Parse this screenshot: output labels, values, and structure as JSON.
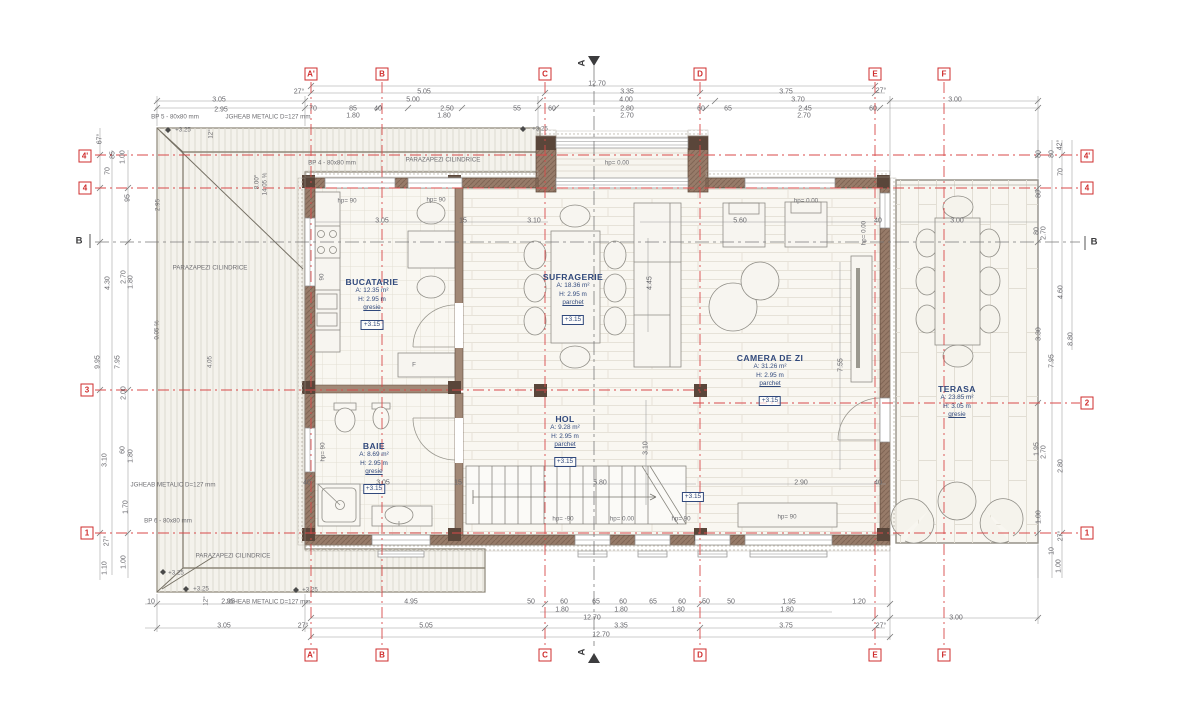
{
  "drawing_title": "Floor plan - parter/etaj",
  "colors": {
    "grid_red": "#d84a4a",
    "wall_brown": "#977b69",
    "wall_dark": "#5d4939",
    "room_label_blue": "#31497c",
    "dim_gray": "#67676c",
    "roof_fill": "#f4f2ec",
    "floor_cream": "#f9f7f1"
  },
  "grid": {
    "markers": [
      {
        "t": "A'",
        "x": 311,
        "y": 74
      },
      {
        "t": "B",
        "x": 382,
        "y": 74
      },
      {
        "t": "C",
        "x": 545,
        "y": 74
      },
      {
        "t": "D",
        "x": 700,
        "y": 74
      },
      {
        "t": "E",
        "x": 875,
        "y": 74
      },
      {
        "t": "F",
        "x": 944,
        "y": 74
      },
      {
        "t": "A'",
        "x": 311,
        "y": 655
      },
      {
        "t": "B",
        "x": 382,
        "y": 655
      },
      {
        "t": "C",
        "x": 545,
        "y": 655
      },
      {
        "t": "D",
        "x": 700,
        "y": 655
      },
      {
        "t": "E",
        "x": 875,
        "y": 655
      },
      {
        "t": "F",
        "x": 944,
        "y": 655
      },
      {
        "t": "4'",
        "x": 85,
        "y": 156
      },
      {
        "t": "4",
        "x": 85,
        "y": 188
      },
      {
        "t": "3",
        "x": 87,
        "y": 390
      },
      {
        "t": "1",
        "x": 87,
        "y": 533
      },
      {
        "t": "4'",
        "x": 1087,
        "y": 156
      },
      {
        "t": "4",
        "x": 1087,
        "y": 188
      },
      {
        "t": "2",
        "x": 1087,
        "y": 403
      },
      {
        "t": "1",
        "x": 1087,
        "y": 533
      }
    ]
  },
  "rooms": [
    {
      "id": "bucatarie",
      "name": "BUCATARIE",
      "area": "A: 12.35 m²",
      "height": "H: 2.95 m",
      "floor": "gresie",
      "level": "+3.15",
      "x": 372,
      "y": 277
    },
    {
      "id": "sufragerie",
      "name": "SUFRAGERIE",
      "area": "A: 18.36 m²",
      "height": "H: 2.95 m",
      "floor": "parchet",
      "level": "+3.15",
      "x": 573,
      "y": 272
    },
    {
      "id": "camera-de-zi",
      "name": "CAMERA DE ZI",
      "area": "A: 31.26 m²",
      "height": "H: 2.95 m",
      "floor": "parchet",
      "level": "+3.15",
      "x": 770,
      "y": 353
    },
    {
      "id": "hol",
      "name": "HOL",
      "area": "A: 9.28 m²",
      "height": "H: 2.95 m",
      "floor": "parchet",
      "level": "+3.15",
      "x": 565,
      "y": 414
    },
    {
      "id": "baie",
      "name": "BAIE",
      "area": "A: 8.69 m²",
      "height": "H: 2.95 m",
      "floor": "gresie",
      "level": "+3.15",
      "x": 374,
      "y": 441
    },
    {
      "id": "terasa",
      "name": "TERASA",
      "area": "A: 23.85 m²",
      "height": "H: 3.05 m",
      "floor": "gresie",
      "level": "",
      "x": 957,
      "y": 384
    }
  ],
  "labels": [
    {
      "t": "12.70",
      "x": 597,
      "y": 84
    },
    {
      "t": "27°",
      "x": 299,
      "y": 92
    },
    {
      "t": "5.05",
      "x": 424,
      "y": 92
    },
    {
      "t": "3.35",
      "x": 627,
      "y": 92
    },
    {
      "t": "3.75",
      "x": 786,
      "y": 92
    },
    {
      "t": "27°",
      "x": 881,
      "y": 91
    },
    {
      "t": "3.05",
      "x": 219,
      "y": 100
    },
    {
      "t": "5.00",
      "x": 413,
      "y": 100
    },
    {
      "t": "4.00",
      "x": 626,
      "y": 100
    },
    {
      "t": "3.70",
      "x": 798,
      "y": 100
    },
    {
      "t": "3.00",
      "x": 955,
      "y": 100
    },
    {
      "t": "2.95",
      "x": 221,
      "y": 110
    },
    {
      "t": "70",
      "x": 313,
      "y": 109
    },
    {
      "t": "85",
      "x": 353,
      "y": 109
    },
    {
      "t": "40",
      "x": 378,
      "y": 109
    },
    {
      "t": "2.50",
      "x": 447,
      "y": 109
    },
    {
      "t": "55",
      "x": 517,
      "y": 109
    },
    {
      "t": "60",
      "x": 552,
      "y": 109
    },
    {
      "t": "2.80",
      "x": 627,
      "y": 109
    },
    {
      "t": "60",
      "x": 701,
      "y": 109
    },
    {
      "t": "65",
      "x": 728,
      "y": 109
    },
    {
      "t": "2.45",
      "x": 805,
      "y": 109
    },
    {
      "t": "60",
      "x": 873,
      "y": 109
    },
    {
      "t": "1.80",
      "x": 353,
      "y": 116
    },
    {
      "t": "1.80",
      "x": 444,
      "y": 116
    },
    {
      "t": "2.70",
      "x": 627,
      "y": 116
    },
    {
      "t": "2.70",
      "x": 804,
      "y": 116
    },
    {
      "t": "BP 5 - 80x80 mm",
      "x": 175,
      "y": 117,
      "c": "ann"
    },
    {
      "t": "JGHEAB METALIC D=127 mm",
      "x": 268,
      "y": 117,
      "c": "ann"
    },
    {
      "t": "+3.25",
      "x": 183,
      "y": 130,
      "c": "ann"
    },
    {
      "t": "+3.25",
      "x": 540,
      "y": 129,
      "c": "ann"
    },
    {
      "t": "BP 4 - 80x80 mm",
      "x": 332,
      "y": 163,
      "c": "ann"
    },
    {
      "t": "PARAZAPEZI CILINDRICE",
      "x": 443,
      "y": 160,
      "c": "ann"
    },
    {
      "t": "hp= 0.00",
      "x": 617,
      "y": 163,
      "c": "ann"
    },
    {
      "t": "67°",
      "x": 100,
      "y": 139,
      "r": 1
    },
    {
      "t": "70",
      "x": 108,
      "y": 171,
      "r": 1
    },
    {
      "t": "85",
      "x": 113,
      "y": 155,
      "r": 1
    },
    {
      "t": "1.00",
      "x": 123,
      "y": 157,
      "r": 1
    },
    {
      "t": "95",
      "x": 128,
      "y": 198,
      "r": 1
    },
    {
      "t": "2.70",
      "x": 124,
      "y": 277,
      "r": 1
    },
    {
      "t": "1.80",
      "x": 131,
      "y": 282,
      "r": 1
    },
    {
      "t": "4.30",
      "x": 108,
      "y": 283,
      "r": 1
    },
    {
      "t": "9.95",
      "x": 98,
      "y": 362,
      "r": 1
    },
    {
      "t": "7.95",
      "x": 118,
      "y": 362,
      "r": 1
    },
    {
      "t": "2.00",
      "x": 124,
      "y": 393,
      "r": 1
    },
    {
      "t": "3.10",
      "x": 105,
      "y": 460,
      "r": 1
    },
    {
      "t": "60",
      "x": 123,
      "y": 450,
      "r": 1
    },
    {
      "t": "1.80",
      "x": 131,
      "y": 456,
      "r": 1
    },
    {
      "t": "1.70",
      "x": 126,
      "y": 507,
      "r": 1
    },
    {
      "t": "27°",
      "x": 107,
      "y": 541,
      "r": 1
    },
    {
      "t": "1.10",
      "x": 105,
      "y": 568,
      "r": 1
    },
    {
      "t": "1.00",
      "x": 124,
      "y": 562,
      "r": 1
    },
    {
      "t": "2.95",
      "x": 158,
      "y": 205,
      "r": 1,
      "c": "ann"
    },
    {
      "t": "4.05",
      "x": 210,
      "y": 362,
      "r": 1,
      "c": "ann"
    },
    {
      "t": "8.00°",
      "x": 257,
      "y": 182,
      "r": 1,
      "c": "ann"
    },
    {
      "t": "14.05 %",
      "x": 265,
      "y": 184,
      "r": 1,
      "c": "ann"
    },
    {
      "t": "12°",
      "x": 211,
      "y": 134,
      "r": 1,
      "c": "ann"
    },
    {
      "t": "12°",
      "x": 206,
      "y": 601,
      "r": 1,
      "c": "ann"
    },
    {
      "t": "0.05 %",
      "x": 157,
      "y": 330,
      "r": 1,
      "c": "ann"
    },
    {
      "t": "PARAZAPEZI CILINDRICE",
      "x": 210,
      "y": 268,
      "c": "ann"
    },
    {
      "t": "JGHEAB METALIC D=127 mm",
      "x": 173,
      "y": 485,
      "c": "ann"
    },
    {
      "t": "BP 6 - 80x80 mm",
      "x": 168,
      "y": 521,
      "c": "ann"
    },
    {
      "t": "+3.25",
      "x": 176,
      "y": 573,
      "c": "ann"
    },
    {
      "t": "+3.25",
      "x": 201,
      "y": 589,
      "c": "ann"
    },
    {
      "t": "+3.25",
      "x": 310,
      "y": 590,
      "c": "ann"
    },
    {
      "t": "PARAZAPEZI CILINDRICE",
      "x": 233,
      "y": 556,
      "c": "ann"
    },
    {
      "t": "JGHEAB METALIC D=127 mm",
      "x": 268,
      "y": 602,
      "c": "ann"
    },
    {
      "t": "10",
      "x": 151,
      "y": 602
    },
    {
      "t": "2.95",
      "x": 228,
      "y": 602
    },
    {
      "t": "4.95",
      "x": 411,
      "y": 602
    },
    {
      "t": "50",
      "x": 531,
      "y": 602
    },
    {
      "t": "60",
      "x": 564,
      "y": 602
    },
    {
      "t": "65",
      "x": 596,
      "y": 602
    },
    {
      "t": "60",
      "x": 623,
      "y": 602
    },
    {
      "t": "65",
      "x": 653,
      "y": 602
    },
    {
      "t": "60",
      "x": 682,
      "y": 602
    },
    {
      "t": "50",
      "x": 706,
      "y": 602
    },
    {
      "t": "50",
      "x": 731,
      "y": 602
    },
    {
      "t": "1.95",
      "x": 789,
      "y": 602
    },
    {
      "t": "1.20",
      "x": 859,
      "y": 602
    },
    {
      "t": "1.80",
      "x": 562,
      "y": 610
    },
    {
      "t": "1.80",
      "x": 621,
      "y": 610
    },
    {
      "t": "1.80",
      "x": 678,
      "y": 610
    },
    {
      "t": "1.80",
      "x": 787,
      "y": 610
    },
    {
      "t": "12.70",
      "x": 592,
      "y": 618
    },
    {
      "t": "3.00",
      "x": 956,
      "y": 618
    },
    {
      "t": "3.05",
      "x": 224,
      "y": 626
    },
    {
      "t": "27°",
      "x": 303,
      "y": 626
    },
    {
      "t": "5.05",
      "x": 426,
      "y": 626
    },
    {
      "t": "3.35",
      "x": 621,
      "y": 626
    },
    {
      "t": "3.75",
      "x": 786,
      "y": 626
    },
    {
      "t": "27°",
      "x": 881,
      "y": 626
    },
    {
      "t": "12.70",
      "x": 601,
      "y": 635
    },
    {
      "t": "42°",
      "x": 1060,
      "y": 145,
      "r": 1
    },
    {
      "t": "80",
      "x": 1039,
      "y": 154,
      "r": 1
    },
    {
      "t": "80",
      "x": 1052,
      "y": 154,
      "r": 1
    },
    {
      "t": "70",
      "x": 1061,
      "y": 172,
      "r": 1
    },
    {
      "t": "80",
      "x": 1039,
      "y": 194,
      "r": 1
    },
    {
      "t": "80",
      "x": 1037,
      "y": 231,
      "r": 1
    },
    {
      "t": "2.70",
      "x": 1044,
      "y": 233,
      "r": 1
    },
    {
      "t": "4.60",
      "x": 1061,
      "y": 292,
      "r": 1
    },
    {
      "t": "3.30",
      "x": 1039,
      "y": 334,
      "r": 1
    },
    {
      "t": "8.80",
      "x": 1071,
      "y": 339,
      "r": 1
    },
    {
      "t": "7.95",
      "x": 1052,
      "y": 361,
      "r": 1
    },
    {
      "t": "1.95",
      "x": 1037,
      "y": 449,
      "r": 1
    },
    {
      "t": "2.70",
      "x": 1044,
      "y": 452,
      "r": 1
    },
    {
      "t": "2.80",
      "x": 1061,
      "y": 466,
      "r": 1
    },
    {
      "t": "1.00",
      "x": 1039,
      "y": 517,
      "r": 1
    },
    {
      "t": "27°",
      "x": 1061,
      "y": 536,
      "r": 1
    },
    {
      "t": "10",
      "x": 1052,
      "y": 551,
      "r": 1
    },
    {
      "t": "1.00",
      "x": 1059,
      "y": 566,
      "r": 1
    },
    {
      "t": "hp= 90",
      "x": 347,
      "y": 201,
      "c": "ann"
    },
    {
      "t": "hp= 90",
      "x": 436,
      "y": 200,
      "c": "ann"
    },
    {
      "t": "3.05",
      "x": 382,
      "y": 221
    },
    {
      "t": "15",
      "x": 463,
      "y": 221
    },
    {
      "t": "3.10",
      "x": 534,
      "y": 221
    },
    {
      "t": "5.60",
      "x": 740,
      "y": 221
    },
    {
      "t": "hp= 0.00",
      "x": 806,
      "y": 201,
      "c": "ann"
    },
    {
      "t": "40",
      "x": 878,
      "y": 221
    },
    {
      "t": "hp= 0.00",
      "x": 864,
      "y": 233,
      "r": 1,
      "c": "ann"
    },
    {
      "t": "4.45",
      "x": 650,
      "y": 283,
      "r": 1
    },
    {
      "t": "7.55",
      "x": 841,
      "y": 365,
      "r": 1
    },
    {
      "t": "90",
      "x": 322,
      "y": 277,
      "r": 1,
      "c": "ann"
    },
    {
      "t": "3.00",
      "x": 957,
      "y": 221
    },
    {
      "t": "hp= 90",
      "x": 323,
      "y": 452,
      "r": 1,
      "c": "ann"
    },
    {
      "t": "40",
      "x": 307,
      "y": 483
    },
    {
      "t": "3.05",
      "x": 383,
      "y": 483
    },
    {
      "t": "15",
      "x": 458,
      "y": 483
    },
    {
      "t": "5.80",
      "x": 600,
      "y": 483
    },
    {
      "t": "3.10",
      "x": 646,
      "y": 448,
      "r": 1
    },
    {
      "t": "hp= -90",
      "x": 563,
      "y": 519,
      "c": "ann"
    },
    {
      "t": "hp= 0.00",
      "x": 622,
      "y": 519,
      "c": "ann"
    },
    {
      "t": "hp= 90",
      "x": 681,
      "y": 519,
      "c": "ann"
    },
    {
      "t": "hp= 90",
      "x": 787,
      "y": 517,
      "c": "ann"
    },
    {
      "t": "2.90",
      "x": 801,
      "y": 483
    },
    {
      "t": "40",
      "x": 878,
      "y": 483
    },
    {
      "t": "+3.15",
      "x": 693,
      "y": 497,
      "c": "lvl"
    },
    {
      "t": "F",
      "x": 414,
      "y": 365,
      "c": "ann"
    },
    {
      "t": "B",
      "x": 79,
      "y": 241,
      "c": "sec"
    },
    {
      "t": "B",
      "x": 1094,
      "y": 242,
      "c": "sec"
    },
    {
      "t": "A",
      "x": 582,
      "y": 63,
      "c": "sec",
      "r": 1
    },
    {
      "t": "A",
      "x": 582,
      "y": 652,
      "c": "sec",
      "r": 1
    }
  ]
}
